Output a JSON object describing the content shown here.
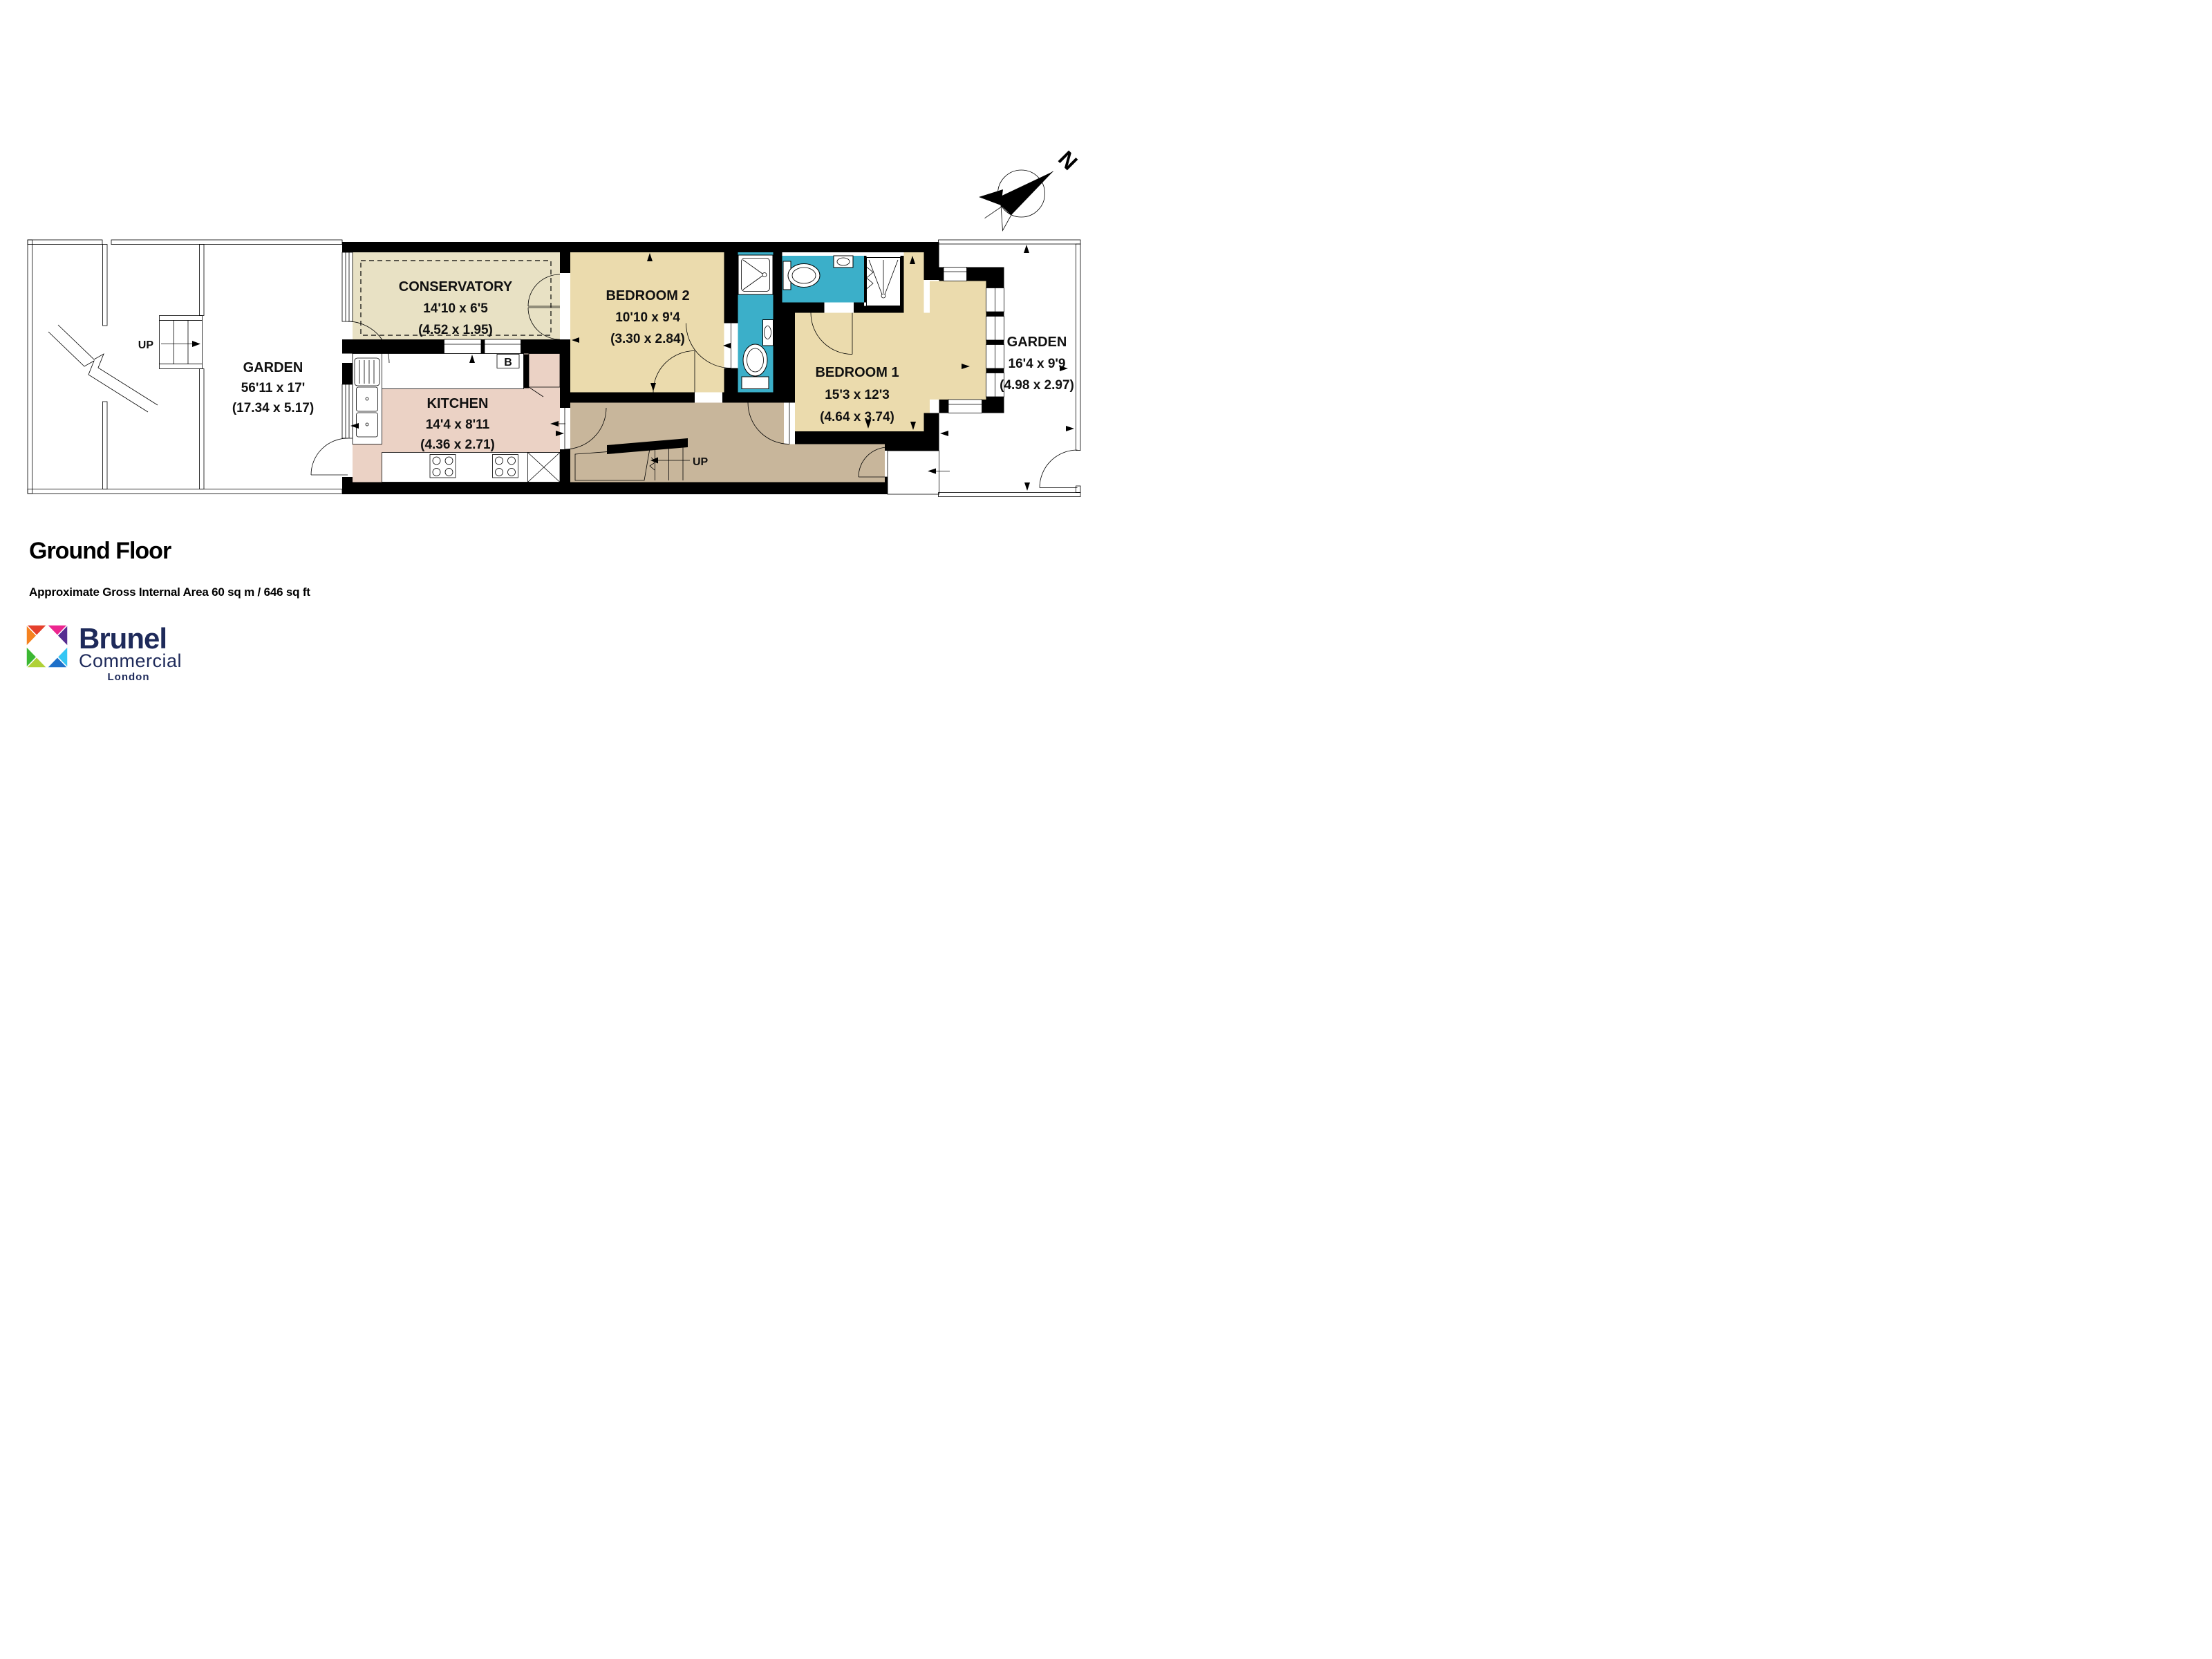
{
  "page": {
    "title": "Ground Floor",
    "subtitle": "Approximate Gross Internal Area 60 sq m  /  646 sq ft"
  },
  "compass": {
    "north": "N"
  },
  "rooms": {
    "garden_left": {
      "name": "GARDEN",
      "size_imperial": "56'11 x 17'",
      "size_metric": "(17.34 x 5.17)"
    },
    "conservatory": {
      "name": "CONSERVATORY",
      "size_imperial": "14'10 x 6'5",
      "size_metric": "(4.52 x 1.95)"
    },
    "kitchen": {
      "name": "KITCHEN",
      "size_imperial": "14'4 x 8'11",
      "size_metric": "(4.36 x 2.71)"
    },
    "bedroom_2": {
      "name": "BEDROOM 2",
      "size_imperial": "10'10 x 9'4",
      "size_metric": "(3.30 x 2.84)"
    },
    "bedroom_1": {
      "name": "BEDROOM 1",
      "size_imperial": "15'3 x 12'3",
      "size_metric": "(4.64 x 3.74)"
    },
    "garden_right": {
      "name": "GARDEN",
      "size_imperial": "16'4 x 9'9",
      "size_metric": "(4.98 x 2.97)"
    }
  },
  "annotations": {
    "garden_stairs_up": "UP",
    "hall_stairs_up": "UP",
    "boiler": "B"
  },
  "logo": {
    "brand": "Brunel",
    "division": "Commercial",
    "city": "London"
  },
  "colors": {
    "wall": "#000000",
    "bedroom_fill": "#EBDBAD",
    "conservatory_fill": "#E8E1C4",
    "kitchen_fill": "#EBD2C5",
    "hall_fill": "#C8B69B",
    "bathroom_fill": "#3BAFC9",
    "appliance_gray": "#C2C2C2",
    "logo_navy": "#1E2A5A",
    "logo_tiles": {
      "red": "#E5402C",
      "orange": "#F5821F",
      "magenta": "#EC268F",
      "purple": "#562D91",
      "green": "#3CB832",
      "lime": "#AFD136",
      "cyan": "#35C6F4",
      "blue": "#1D70C9"
    }
  }
}
